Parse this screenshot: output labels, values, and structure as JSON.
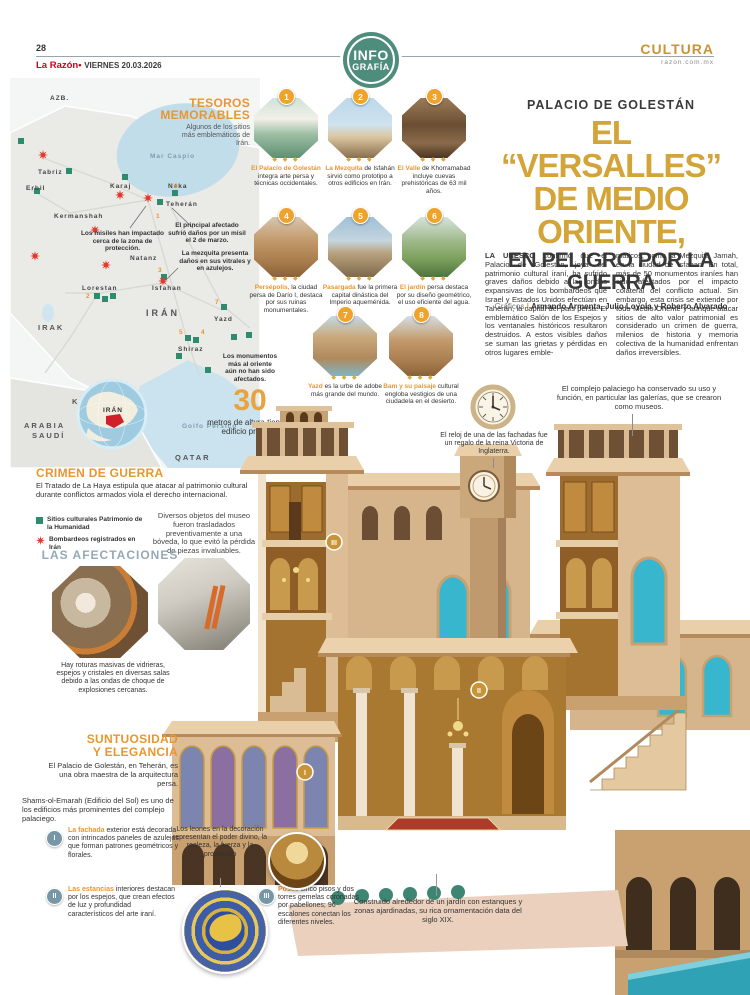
{
  "colors": {
    "accent_orange": "#e8972f",
    "headline_gold": "#d3a437",
    "brand_red": "#d0021b",
    "badge_green": "#4e8c7b",
    "heritage_green": "#2e8b6e",
    "bomb_red": "#e23a2e",
    "afectaciones_blue": "#94aab6",
    "sea_blue": "#c2ddea",
    "turquoise_window": "#38b6cd"
  },
  "header": {
    "page_number": "28",
    "brand": "La Razón",
    "bullet": "•",
    "date": "VIERNES 20.03.2026",
    "section": "CULTURA",
    "site": "razon.com.mx",
    "badge_line1": "INFO",
    "badge_line2": "GRAFÍA"
  },
  "headline": {
    "kicker": "PALACIO DE GOLESTÁN",
    "title_line1": "EL “VERSALLES”",
    "title_line2": "DE MEDIO ORIENTE,",
    "title_line3": "EN PELIGRO POR LA GUERRA",
    "byline_label": "Gráficos",
    "byline_sep": "|",
    "byline_names": "Armando Armenta, Julio Loyola y Roberto Alvarado"
  },
  "article": {
    "lead": "LA UNESCO",
    "col1": " confirmó que el Palacio de Golestán, joya del patrimonio cultural iraní, ha sufrido graves daños debido a las ondas expansivas de los bombardeos que Israel y Estados Unidos efectúan en Taherán, la capital del país persa. El emblemático Salón de los Espejos y los ventanales históricos resultaron destruidos. A estos visibles daños se suman las grietas y pérdidas en otros lugares emble-",
    "col2": "máticos, como la Mezquita Jamah, en la ciudad de Isfahan. En total, más de 50 monumentos iraníes han sido afectados por el impacto colateral del conflicto actual. Sin embargo, esta crisis se extiende por todo Medio Oriente y aunque atacar sitios de alto valor patrimonial es considerado un crimen de guerra, milenios de historia y memoria colectiva de la humanidad enfrentan daños irreversibles."
  },
  "tesoros": {
    "heading_line1": "TESOROS",
    "heading_line2": "MEMORABLES",
    "intro": "Algunos de los sitios más emblemáticos de Irán.",
    "ornament": "◆ ◆ ◆",
    "items": [
      {
        "num": "1",
        "lead": "El Palacio de Golestán",
        "text": " integra arte persa y técnicas occidentales."
      },
      {
        "num": "2",
        "lead": "La Mezquita",
        "text": " de Isfahán sirvió como prototipo a otros edificios en Irán."
      },
      {
        "num": "3",
        "lead": "El Valle",
        "text": " de Khorramabad incluye cuevas prehistóricas de 63 mil años."
      },
      {
        "num": "4",
        "lead": "Persépolis,",
        "text": " la ciudad persa de Darío I, destaca por sus ruinas monumentales."
      },
      {
        "num": "5",
        "lead": "Pasargada",
        "text": " fue la primera capital dinástica del Imperio aqueménida."
      },
      {
        "num": "6",
        "lead": "El jardín",
        "text": " persa destaca por su diseño geométrico, el uso eficiente del agua."
      },
      {
        "num": "7",
        "lead": "Yazd",
        "text": " es la urbe de adobe más grande del mundo."
      },
      {
        "num": "8",
        "lead": "Bam y su paisaje",
        "text": " cultural engloba vestigios de una ciudadela en el desierto."
      }
    ]
  },
  "map": {
    "region_label": "AZB.",
    "sea_caspio": "Mar Caspio",
    "sea_golfo": "Golfo Pérsico",
    "countries": {
      "iran": "IRÁN",
      "irak": "IRAK",
      "kuwait": "KUWAIT",
      "arabia1": "ARABIA",
      "arabia2": "SAUDÍ",
      "qatar": "QATAR"
    },
    "cities": {
      "tabriz": "Tabriz",
      "erbil": "Erbil",
      "kermanshah": "Kermanshah",
      "karaj": "Karaj",
      "neka": "Neka",
      "teheran": "Teherán",
      "natanz": "Natanz",
      "lorestan": "Lorestan",
      "isfahan": "Isfahan",
      "yazd": "Yazd",
      "shiraz": "Shiraz"
    },
    "globe_label": "IRÁN",
    "numbers": {
      "n1": "1",
      "n2": "2",
      "n3": "3",
      "n4": "4",
      "n5": "5",
      "n6": "6",
      "n7": "7"
    },
    "callout_misiles": "Los misiles han impactado cerca de la zona de protección.",
    "callout_principal": "El principal afectado sufrió daños por un misil el 2 de marzo.",
    "callout_mezquita": "La mezquita presenta daños en sus vitrales y en azulejos.",
    "callout_oriente": "Los monumentos más al oriente aún no han sido afectados."
  },
  "stat": {
    "value": "30",
    "text": "metros de altura tiene el edificio principal"
  },
  "crimen": {
    "heading": "CRIMEN DE GUERRA",
    "text": "El Tratado de La Haya estipula que atacar al patrimonio cultural durante conflictos armados viola el derecho internacional.",
    "legend_sitios": "Sitios culturales Patrimonio de la Humanidad",
    "legend_bombardeos": "Bombardeos registrados en Irán"
  },
  "afectaciones": {
    "heading": "LAS AFECTACIONES",
    "callout_museo": "Diversos objetos del museo fueron trasladados preventivamente a una bóveda, lo que evitó la pérdida de piezas invaluables.",
    "caption": "Hay roturas masivas de vidrieras, espejos y cristales en diversas salas debido a las ondas de choque de explosiones cercanas."
  },
  "suntuosidad": {
    "heading_line1": "SUNTUOSIDAD",
    "heading_line2": "Y ELEGANCIA",
    "intro": "El Palacio de Golestán, en Teherán, es una obra maestra de la arquitectura persa.",
    "para": "Shams-ol-Emarah (Edificio del Sol) es uno de los edificios más prominentes del complejo palaciego.",
    "items": [
      {
        "numeral": "I",
        "lead": "La fachada",
        "text": " exterior está decorada con intrincados paneles de azulejos que forman patrones geométricos y florales."
      },
      {
        "numeral": "II",
        "lead": "Las estancias",
        "text": " interiores destacan por los espejos, que crean efectos de luz y profundidad característicos del arte iraní."
      },
      {
        "numeral": "III",
        "lead": "Posee",
        "text": " cinco pisos y dos torres gemelas coronadas por pabellones; 96 escalones conectan los diferentes niveles."
      }
    ]
  },
  "palace": {
    "marker1": "I",
    "marker2": "II",
    "marker3": "III",
    "callout_galerias": "El complejo palaciego ha conservado su uso y función, en particular las galerías, que se crearon como museos.",
    "callout_reloj": "El reloj de una de las fachadas fue un regalo de la reina Victoria de Inglaterra.",
    "callout_leones": "Los leones en la decoración representan el poder divino, la realeza, la fuerza y la protección",
    "callout_jardin": "Construido alrededor de un jardín con estanques y zonas ajardinadas, su rica ornamentación data del siglo XIX."
  }
}
